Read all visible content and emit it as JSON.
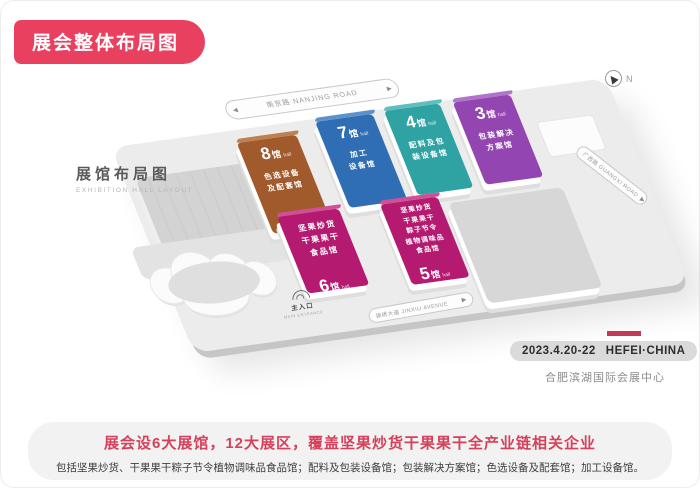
{
  "title_badge": "展会整体布局图",
  "map": {
    "heading": "展馆布局图",
    "heading_en": "EXHIBITION HALL LAYOUT",
    "compass": "N",
    "roads": {
      "top": "南京路  NANJING ROAD",
      "right": "广西路  GUANGXI ROAD",
      "bottom": "锦绣大道  JINXIU AVENUE"
    },
    "main_hall": "主展馆",
    "entrance": {
      "label": "主入口",
      "en": "MAIN ENTRANCE"
    },
    "halls": [
      {
        "name": "hall-8",
        "num": "8",
        "unit": "馆",
        "unit_sub": "hall",
        "lines": [
          "色选设备",
          "及配套馆"
        ],
        "color": "#A05A2C",
        "color_light": "#BE8050"
      },
      {
        "name": "hall-7",
        "num": "7",
        "unit": "馆",
        "unit_sub": "hall",
        "lines": [
          "加工",
          "设备馆"
        ],
        "color": "#2F6EB5",
        "color_light": "#5C92CC"
      },
      {
        "name": "hall-4",
        "num": "4",
        "unit": "馆",
        "unit_sub": "hall",
        "lines": [
          "配料及包",
          "装设备馆"
        ],
        "color": "#2FA2A3",
        "color_light": "#5FBFBF"
      },
      {
        "name": "hall-3",
        "num": "3",
        "unit": "馆",
        "unit_sub": "hall",
        "lines": [
          "包装解决",
          "方案馆"
        ],
        "color": "#9346B2",
        "color_light": "#B273CB"
      },
      {
        "name": "hall-6",
        "num": "6",
        "unit": "馆",
        "unit_sub": "hall",
        "lines": [
          "坚果炒货",
          "干果果干",
          "食品馆"
        ],
        "color": "#B41A70",
        "color_light": "#D04F97"
      },
      {
        "name": "hall-5",
        "num": "5",
        "unit": "馆",
        "unit_sub": "hall",
        "lines": [
          "坚果炒货",
          "干果果干",
          "粽子节令",
          "植物调味品",
          "食品馆"
        ],
        "color": "#B41A70",
        "color_light": "#D04F97"
      }
    ],
    "event": {
      "date": "2023.4.20-22",
      "city": "HEFEI·CHINA",
      "venue": "合肥滨湖国际会展中心"
    }
  },
  "footer": {
    "line1": "展会设6大展馆，12大展区，覆盖坚果炒货干果果干全产业链相关企业",
    "line2": "包括坚果炒货、干果果干粽子节令植物调味品食品馆；配料及包装设备馆；包装解决方案馆；色选设备及配套馆；加工设备馆。"
  },
  "icons": {
    "arrow_left": "◀",
    "arrow_right": "▶"
  },
  "colors": {
    "accent_red": "#E8405E",
    "footer_red": "#D6405A",
    "bar_crimson": "#C23A56"
  }
}
